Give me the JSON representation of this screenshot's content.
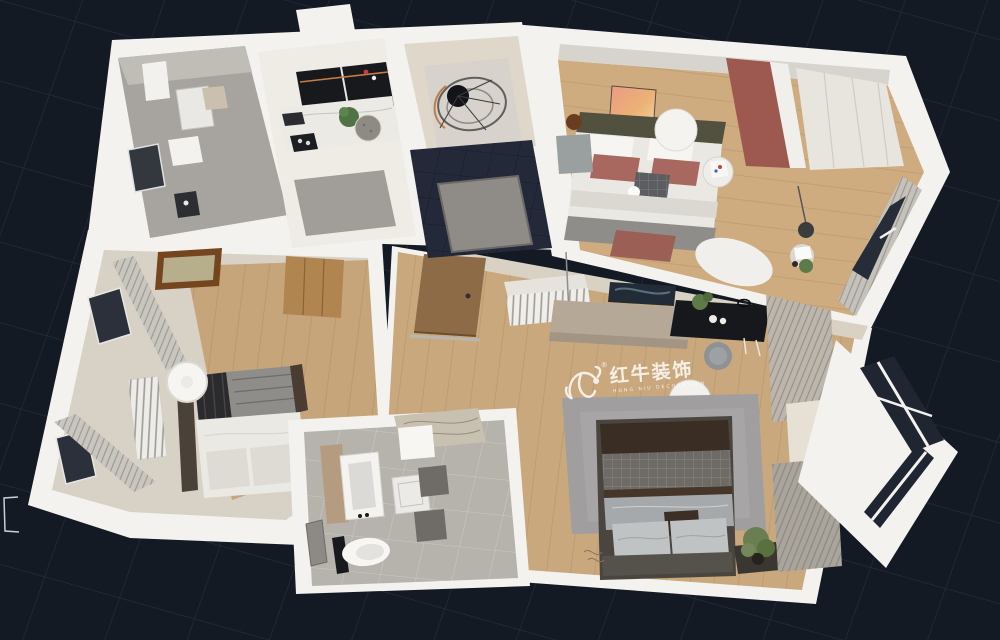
{
  "canvas": {
    "background": "#131a24",
    "grid_line": "#28303f"
  },
  "watermark": {
    "brand": "红牛装饰",
    "subtitle": "HONG NIU DECORATION",
    "registered": "®",
    "color": "#ffffff"
  },
  "palette": {
    "wall": "#f3f2ee",
    "wall_band": "#d9d1c4",
    "wood_floor": "#c9a87d",
    "wood_floor_master": "#cfab80",
    "wood_floor_bedroom": "#c6a57a",
    "tile_gray": "#b6b2ac",
    "tile_gray_upper": "#a7a39e",
    "tile_dark": "#232938",
    "beige_floor": "#ded7ca",
    "rug_gray": "#a19e9f",
    "accent_maroon": "#9d5950",
    "glass_dark": "#1f2531",
    "curtain": "#c9c6bf",
    "bed_dark_brown": "#3a2d24",
    "console_black": "#17181b"
  }
}
